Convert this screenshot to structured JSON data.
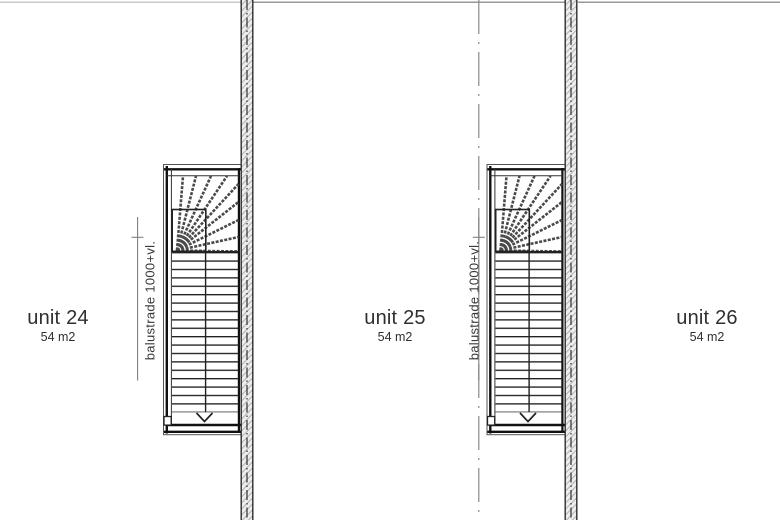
{
  "plan": {
    "units": [
      {
        "name": "unit 24",
        "area": "54 m2"
      },
      {
        "name": "unit 25",
        "area": "54 m2"
      },
      {
        "name": "unit 26",
        "area": "54 m2"
      }
    ],
    "stairs": [
      {
        "balustrade_label": "balustrade 1000+vl."
      },
      {
        "balustrade_label": "balustrade 1000+vl."
      }
    ],
    "colors": {
      "background": "#ffffff",
      "stair_line_dark": "#1c1c1c",
      "stair_line_thin": "#333333",
      "winder_tread": "#4a4a4a",
      "wall_edge": "#2c2c2c",
      "wall_fill": "#ededed",
      "wall_hatch": "#b5b5b5",
      "wall_centerline": "#2f2f2f",
      "divider_line": "#8a8a8a",
      "leader_line": "#808080",
      "top_boundary_light": "#b9b9b9",
      "top_boundary_dark": "#777777",
      "text": "#2f2f2f"
    }
  }
}
